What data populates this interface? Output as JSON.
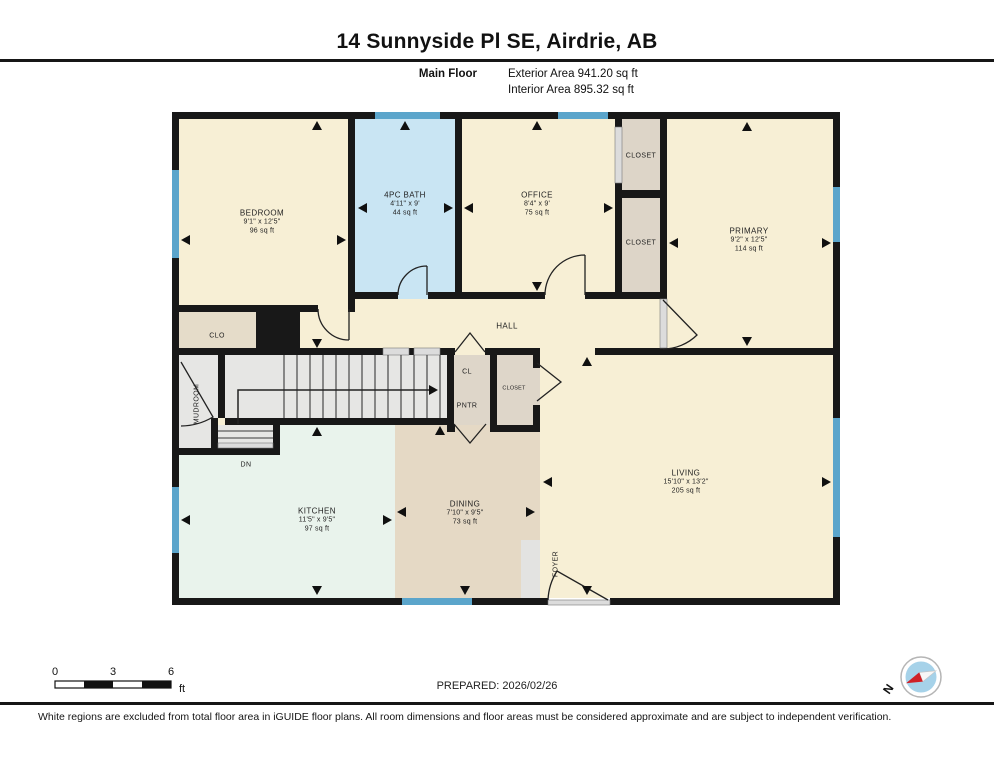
{
  "header": {
    "title": "14 Sunnyside Pl SE, Airdrie, AB",
    "floor_label": "Main Floor",
    "exterior_area": "Exterior Area 941.20 sq ft",
    "interior_area": "Interior Area 895.32 sq ft"
  },
  "rooms": {
    "bedroom": {
      "name": "BEDROOM",
      "dims": "9'1\" x 12'5\"",
      "area": "96 sq ft"
    },
    "bath": {
      "name": "4PC BATH",
      "dims": "4'11\" x 9'",
      "area": "44 sq ft"
    },
    "office": {
      "name": "OFFICE",
      "dims": "8'4\" x 9'",
      "area": "75 sq ft"
    },
    "closet_top": {
      "name": "CLOSET"
    },
    "closet_mid": {
      "name": "CLOSET"
    },
    "primary": {
      "name": "PRIMARY",
      "dims": "9'2\" x 12'5\"",
      "area": "114 sq ft"
    },
    "hall": {
      "name": "HALL"
    },
    "clo": {
      "name": "CLO"
    },
    "mudroom": {
      "name": "MUDROOM"
    },
    "cl": {
      "name": "CL"
    },
    "pntr": {
      "name": "PNTR"
    },
    "closet_small": {
      "name": "CLOSET"
    },
    "stairs": {
      "dn_label": "DN"
    },
    "kitchen": {
      "name": "KITCHEN",
      "dims": "11'5\" x 9'5\"",
      "area": "97 sq ft"
    },
    "dining": {
      "name": "DINING",
      "dims": "7'10\" x 9'5\"",
      "area": "73 sq ft"
    },
    "living": {
      "name": "LIVING",
      "dims": "15'10\" x 13'2\"",
      "area": "205 sq ft"
    },
    "foyer": {
      "name": "FOYER"
    }
  },
  "scale_bar": {
    "tick0": "0",
    "tick1": "3",
    "tick2": "6",
    "unit": "ft"
  },
  "footer": {
    "prepared": "PREPARED: 2026/02/26",
    "compass_label": "N",
    "disclaimer": "White regions are excluded from total floor area in iGUIDE floor plans. All room dimensions and floor areas must be considered approximate and are subject to independent verification."
  },
  "colors": {
    "wall": "#181818",
    "cream": "#f7efd5",
    "bath": "#c9e5f3",
    "closet": "#ddd5c8",
    "clo": "#e5dcc9",
    "grey": "#e6e6e4",
    "mint": "#e9f3ec",
    "tan": "#e5d9c5",
    "window": "#5ba5cb",
    "compassblue": "#a6d2e9",
    "compassred": "#cf2127"
  }
}
